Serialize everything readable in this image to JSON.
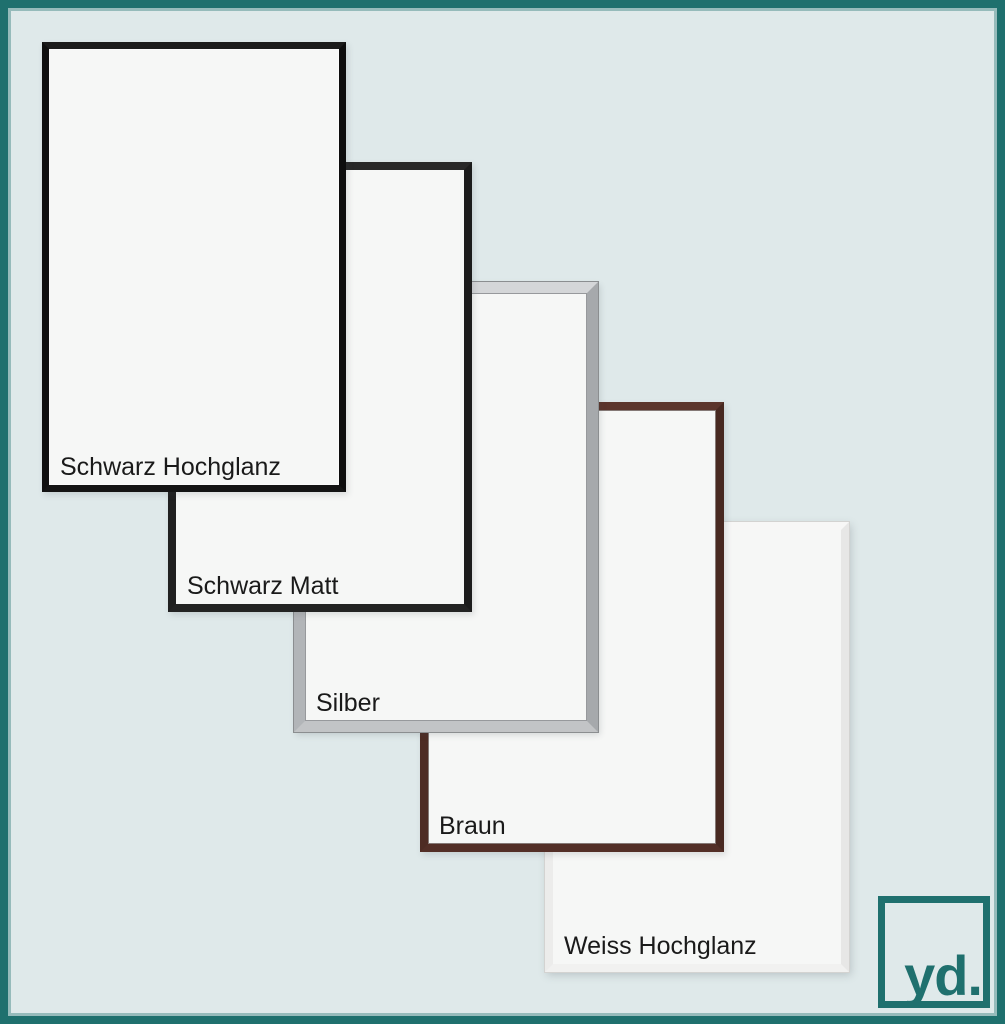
{
  "canvas": {
    "background_color": "#dfe9ea",
    "border_color": "#1f706e"
  },
  "frames": [
    {
      "label": "Schwarz Hochglanz",
      "frame_color": "#141414"
    },
    {
      "label": "Schwarz Matt",
      "frame_color": "#222222"
    },
    {
      "label": "Silber",
      "frame_color": "#b5b8ba"
    },
    {
      "label": "Braun",
      "frame_color": "#53302a"
    },
    {
      "label": "Weiss Hochglanz",
      "frame_color": "#f2f2f1"
    }
  ],
  "logo": {
    "text": "yd.",
    "color": "#1f706e"
  }
}
